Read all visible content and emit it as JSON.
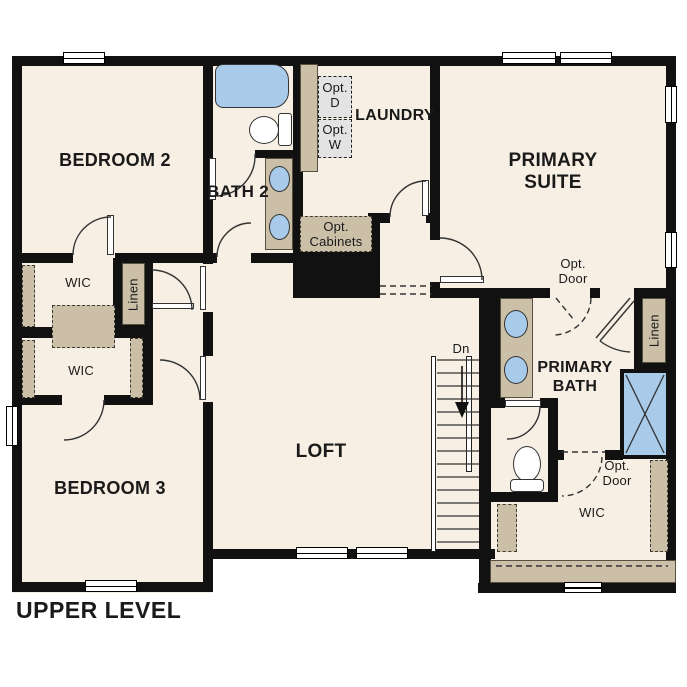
{
  "plan": {
    "title": "UPPER LEVEL",
    "level_name": "Upper Level floor plan"
  },
  "labels": {
    "bedroom2": "BEDROOM 2",
    "bedroom3": "BEDROOM 3",
    "bath2": "BATH 2",
    "laundry": "LAUNDRY",
    "primary_suite": "PRIMARY SUITE",
    "primary_bath": "PRIMARY BATH",
    "loft": "LOFT",
    "wic_upper": "WIC",
    "wic_lower": "WIC",
    "wic_primary": "WIC",
    "linen_left": "Linen",
    "linen_right": "Linen",
    "opt_dryer": "Opt. D",
    "opt_washer": "Opt. W",
    "opt_cabinets": "Opt. Cabinets",
    "opt_door_primary": "Opt. Door",
    "opt_door_wic": "Opt. Door",
    "stairs_down": "Dn"
  },
  "colors": {
    "floor": "#f7efe3",
    "wall": "#111111",
    "fixture_blue": "#a9cbea",
    "cabinet_tan": "#cbbfa7",
    "optional_gray": "#e3e3e3"
  },
  "icons": {
    "stairs_direction": "down-arrow"
  }
}
